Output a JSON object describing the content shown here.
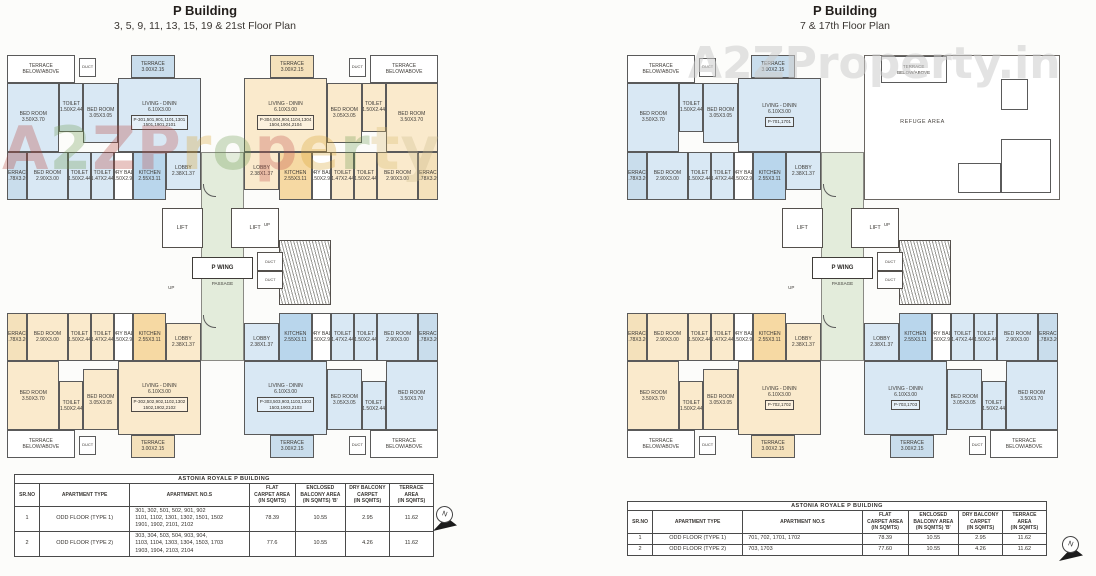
{
  "sheet": {
    "watermark_right": "A2ZProperty.in",
    "compass_n": "N"
  },
  "watermark_left": {
    "letters": [
      {
        "ch": "A",
        "color": "#b5413a"
      },
      {
        "ch": "2",
        "color": "#6e9a50"
      },
      {
        "ch": "Z",
        "color": "#b5413a"
      },
      {
        "ch": "P",
        "color": "#bf4f4a"
      },
      {
        "ch": "r",
        "color": "#d9a430"
      },
      {
        "ch": "o",
        "color": "#6e9a50"
      },
      {
        "ch": "p",
        "color": "#bf4f4a"
      },
      {
        "ch": "e",
        "color": "#d9a430"
      },
      {
        "ch": "r",
        "color": "#6e9a50"
      },
      {
        "ch": "t",
        "color": "#d9b96a"
      },
      {
        "ch": "y",
        "color": "#cbb98a"
      }
    ]
  },
  "room_template": [
    {
      "n": "terrace-belowabove",
      "label": "TERRACE\nBELOW/ABOVE",
      "x": 1,
      "y": 0,
      "w": 31,
      "h": 19,
      "cls": "white"
    },
    {
      "n": "duct",
      "label": "DUCT",
      "x": 34,
      "y": 2,
      "w": 8,
      "h": 13,
      "cls": "white tiny"
    },
    {
      "n": "terrace-top",
      "label": "TERRACE\n3.00X2.15",
      "x": 58,
      "y": 0,
      "w": 20,
      "h": 16,
      "cls": "shade"
    },
    {
      "n": "bedroom-1",
      "label": "BED ROOM\n3.50X3.70",
      "x": 1,
      "y": 19,
      "w": 24,
      "h": 48,
      "cls": "tint"
    },
    {
      "n": "toilet-1",
      "label": "TOILET\n1.50X2.44",
      "x": 25,
      "y": 19,
      "w": 11,
      "h": 34,
      "cls": "tint"
    },
    {
      "n": "bedroom-2",
      "label": "BED ROOM\n3.05X3.05",
      "x": 36,
      "y": 19,
      "w": 16,
      "h": 42,
      "cls": "tint"
    },
    {
      "n": "living-dining",
      "label": "LIVING - DININ\n6.10X3.00",
      "x": 52,
      "y": 16,
      "w": 38,
      "h": 51,
      "cls": "tint living"
    },
    {
      "n": "terrace-side",
      "label": "TERRACE\n1.78X3.20",
      "x": 1,
      "y": 67,
      "w": 9,
      "h": 33,
      "cls": "shade"
    },
    {
      "n": "bedroom-3",
      "label": "BED ROOM\n2.90X3.00",
      "x": 10,
      "y": 67,
      "w": 19,
      "h": 33,
      "cls": "tint"
    },
    {
      "n": "toilet-2",
      "label": "TOILET\n1.50X2.44",
      "x": 29,
      "y": 67,
      "w": 10.5,
      "h": 33,
      "cls": "tint"
    },
    {
      "n": "toilet-3",
      "label": "TOILET\n1.47X2.44",
      "x": 39.5,
      "y": 67,
      "w": 10.5,
      "h": 33,
      "cls": "tint"
    },
    {
      "n": "dry-balcony",
      "label": "DRY BAL.\n1.50X2.95",
      "x": 50,
      "y": 67,
      "w": 9,
      "h": 33,
      "cls": "white"
    },
    {
      "n": "kitchen",
      "label": "KITCHEN\n2.55X3.11",
      "x": 59,
      "y": 67,
      "w": 15,
      "h": 33,
      "cls": "accent"
    },
    {
      "n": "lobby",
      "label": "LOBBY\n2.38X1.37",
      "x": 74,
      "y": 67,
      "w": 16,
      "h": 26,
      "cls": "tint"
    }
  ],
  "plans": [
    {
      "title": "P Building",
      "subtitle": "3, 5, 9, 11, 13, 15, 19 & 21st Floor Plan",
      "core": {
        "lift": "LIFT",
        "wing": "P WING",
        "passage": "PASSAGE",
        "up": "UP",
        "duct": "DUCT"
      },
      "units": [
        {
          "pos": "top-left",
          "fill": "blue",
          "label": "P-301,501,901,1101,1301\n1501,1901,2101"
        },
        {
          "pos": "top-right",
          "fill": "orange",
          "label": "P-304,504,904,1104,1304\n1504,1904,2104"
        },
        {
          "pos": "bottom-left",
          "fill": "orange",
          "label": "P-302,502,902,1102,1302\n1502,1902,2102"
        },
        {
          "pos": "bottom-right",
          "fill": "blue",
          "label": "P-303,503,903,1103,1303\n1503,1903,2103"
        }
      ]
    },
    {
      "title": "P Building",
      "subtitle": "7 & 17th Floor Plan",
      "core": {
        "lift": "LIFT",
        "wing": "P WING",
        "passage": "PASSAGE",
        "up": "UP",
        "duct": "DUCT"
      },
      "refuge": {
        "label": "REFUGE AREA",
        "terrace": "TERRACE\nBELOW/ABOVE"
      },
      "units": [
        {
          "pos": "top-left",
          "fill": "blue",
          "label": "P-701,1701"
        },
        {
          "pos": "bottom-left",
          "fill": "orange",
          "label": "P-702,1702"
        },
        {
          "pos": "bottom-right",
          "fill": "blue",
          "label": "P-703,1703"
        }
      ]
    }
  ],
  "tables": [
    {
      "title": "ASTONIA ROYALE P BUILDING",
      "headers": [
        "SR.NO",
        "APARTMENT TYPE",
        "APARTMENT. NO.S",
        "FLAT\nCARPET AREA\n(IN SQMTS)",
        "ENCLOSED\nBALCONY AREA\n(IN SQMTS) 'B'",
        "DRY BALCONY\nCARPET\n(IN SQMTS)",
        "TERRACE AREA\n(IN SQMTS)"
      ],
      "rows": [
        [
          "1",
          "ODD FLOOR (TYPE 1)",
          "301, 302, 501, 502, 901, 902\n1101, 1102, 1301, 1302, 1501, 1502\n1901, 1902, 2101, 2102",
          "78.39",
          "10.55",
          "2.95",
          "11.62"
        ],
        [
          "2",
          "ODD FLOOR (TYPE 2)",
          "303, 304, 503, 504, 903, 904,\n1103, 1104, 1303, 1304, 1503, 1703\n1903, 1904, 2103, 2104",
          "77.6",
          "10.55",
          "4.26",
          "11.62"
        ]
      ]
    },
    {
      "title": "ASTONIA ROYALE P BUILDING",
      "headers": [
        "SR.NO",
        "APARTMENT TYPE",
        "APARTMENT NO.S",
        "FLAT\nCARPET AREA\n(IN SQMTS)",
        "ENCLOSED\nBALCONY AREA\n(IN SQMTS) 'B'",
        "DRY BALCONY\nCARPET\n(IN SQMTS)",
        "TERRACE AREA\n(IN SQMTS)"
      ],
      "rows": [
        [
          "1",
          "ODD FLOOR (TYPE 1)",
          "701, 702, 1701, 1702",
          "78.39",
          "10.55",
          "2.95",
          "11.62"
        ],
        [
          "2",
          "ODD FLOOR (TYPE 2)",
          "703, 1703",
          "77.60",
          "10.55",
          "4.26",
          "11.62"
        ]
      ]
    }
  ]
}
